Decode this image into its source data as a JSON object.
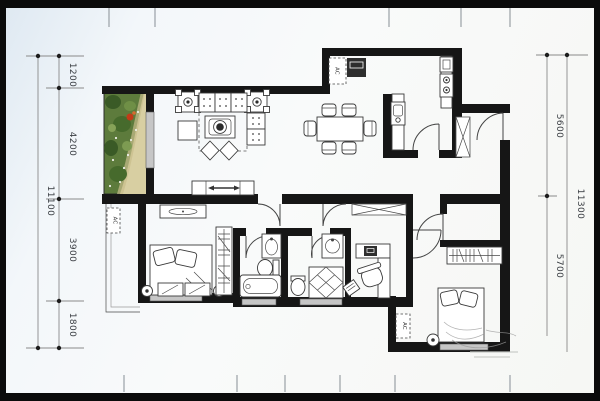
{
  "image": {
    "description": "Black-framed residential apartment floor plan drawing with garden photo inset",
    "frame_color": "#0b0b0b",
    "paper_color": "#f6f8fa"
  },
  "labels": {
    "ac_unit": "AC"
  },
  "dimensions": {
    "left": {
      "total": "11100",
      "segments": [
        "1200",
        "4200",
        "3900",
        "1800"
      ]
    },
    "right": {
      "total": "11300",
      "segments": [
        "5600",
        "5700"
      ]
    }
  },
  "colors": {
    "wall": "#161616",
    "window_fill": "#c6c6c6",
    "dimension_line": "#8a8a8a",
    "garden_green_dark": "#3a5a26",
    "garden_green": "#5d7b3c",
    "garden_path": "#d8cfa2",
    "flower_red": "#c23b18"
  }
}
